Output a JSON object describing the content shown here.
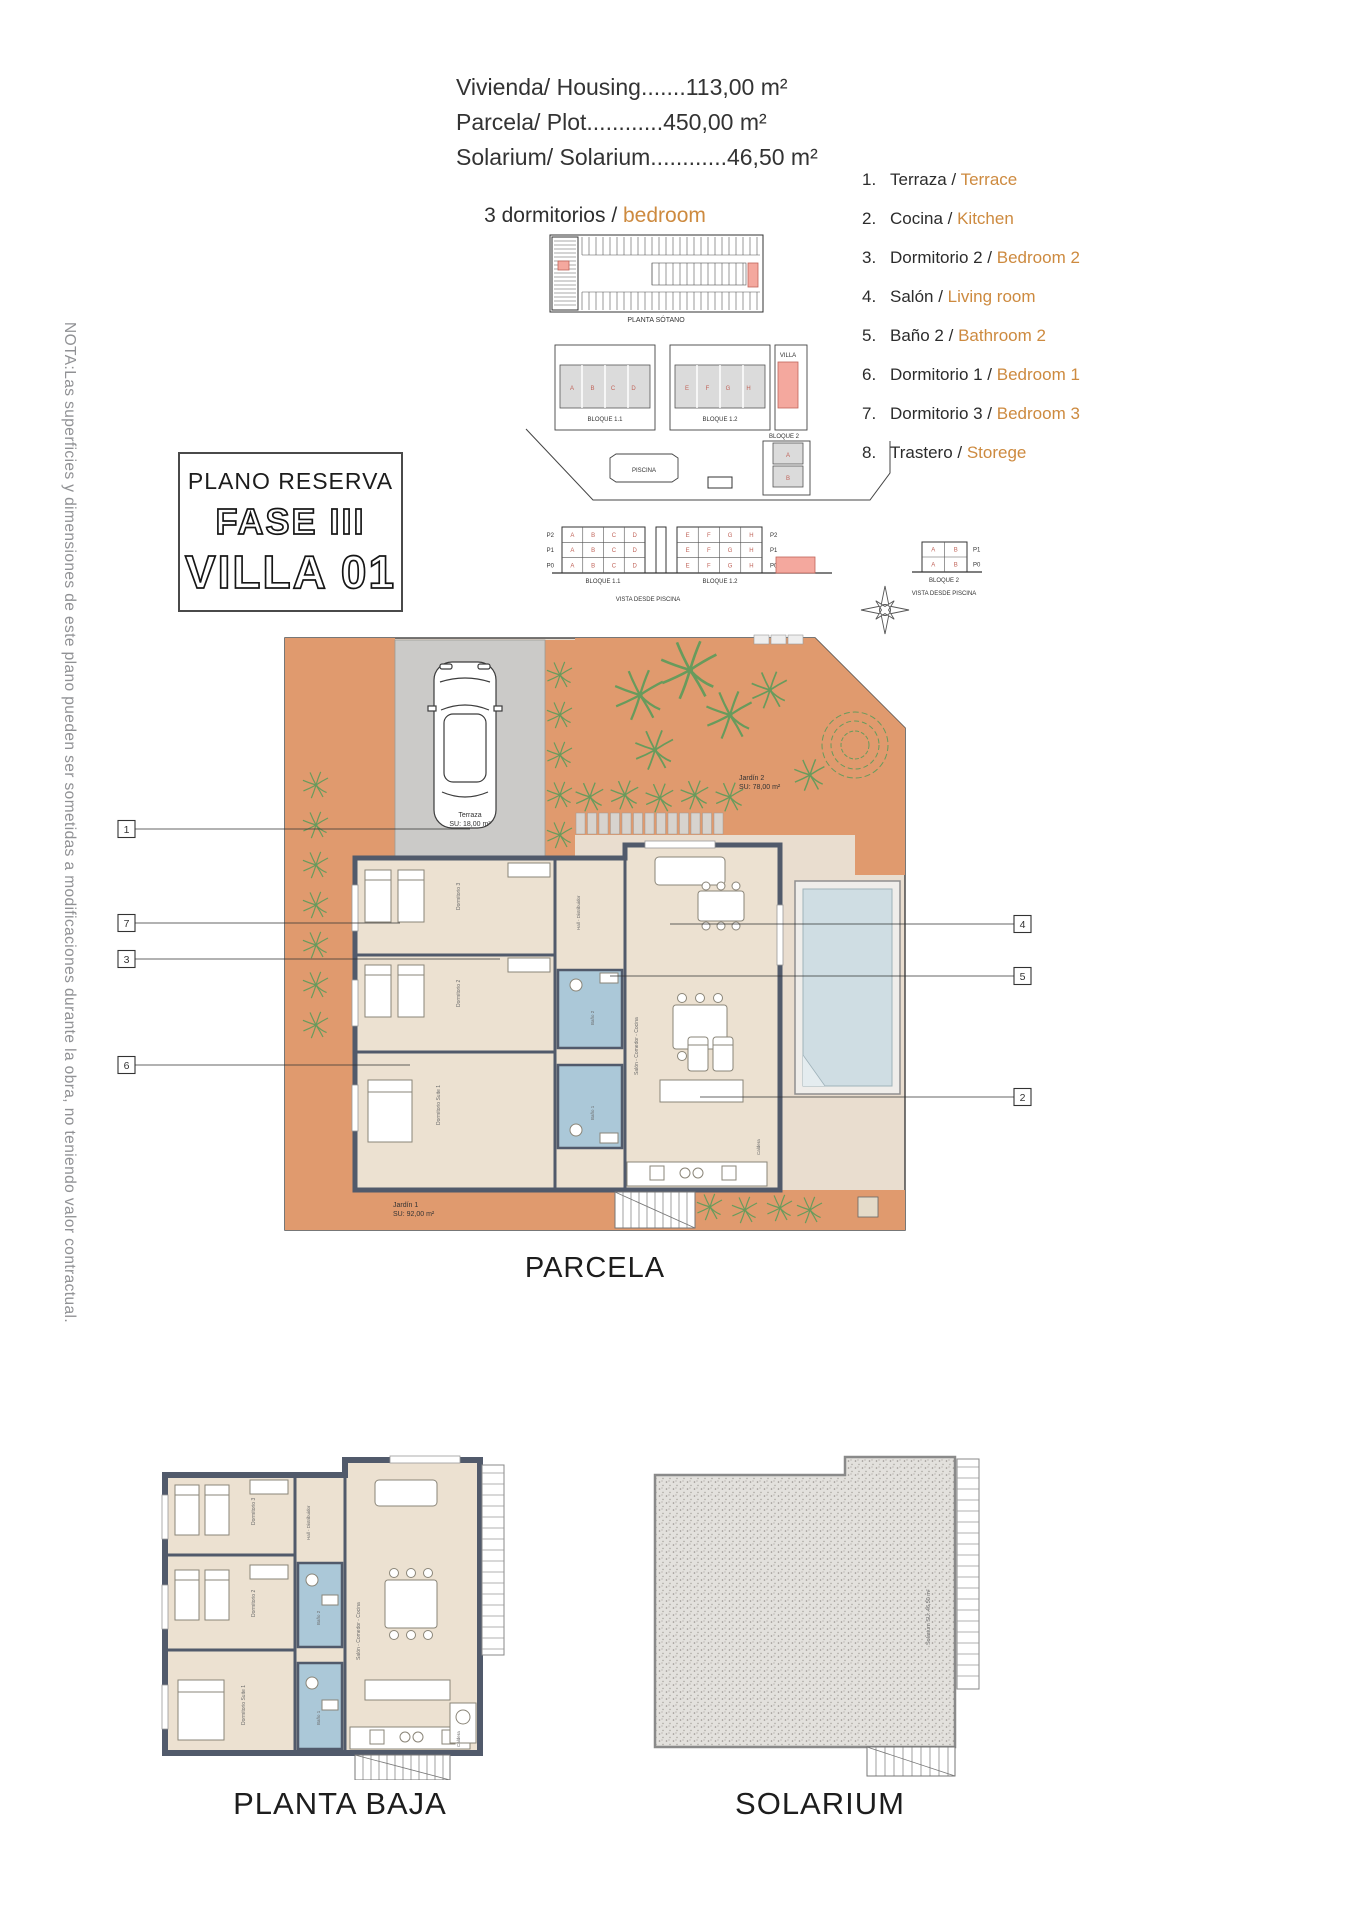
{
  "colors": {
    "accent_orange": "#cd8a3f",
    "terracotta": "#e09a6e",
    "pool_water": "#cfdde3",
    "bath_blue": "#abc8d8",
    "wall": "#515a6b",
    "highlight_pink": "#f4a89e",
    "palm_green": "#689b5c"
  },
  "header": {
    "measurements": [
      "Vivienda/ Housing.......113,00 m²",
      "Parcela/ Plot............450,00 m²",
      "Solarium/ Solarium............46,50 m²"
    ],
    "type_label_es": "3 dormitorios / ",
    "type_label_en": "bedroom"
  },
  "legend": {
    "items": [
      {
        "num": "1.",
        "es": "Terraza / ",
        "en": "Terrace"
      },
      {
        "num": "2.",
        "es": "Cocina / ",
        "en": "Kitchen"
      },
      {
        "num": "3.",
        "es": "Dormitorio 2 / ",
        "en": "Bedroom 2"
      },
      {
        "num": "4.",
        "es": "Salón / ",
        "en": "Living room"
      },
      {
        "num": "5.",
        "es": "Baño 2 / ",
        "en": "Bathroom 2"
      },
      {
        "num": "6.",
        "es": "Dormitorio 1 / ",
        "en": "Bedroom 1"
      },
      {
        "num": "7.",
        "es": "Dormitorio 3 / ",
        "en": "Bedroom 3"
      },
      {
        "num": "8.",
        "es": "Trastero / ",
        "en": "Storege"
      }
    ]
  },
  "title_box": {
    "line1": "PLANO RESERVA",
    "line2": "FASE III",
    "line3": "VILLA 01"
  },
  "note": "NOTA:Las superficies y dimensiones de este plano pueden ser sometidas a modificaciones durante la obra, no teniendo valor contractual.",
  "site": {
    "sotano_caption": "PLANTA SÓTANO",
    "bloque11": "BLOQUE 1.1",
    "bloque12": "BLOQUE 1.2",
    "bloque2": "BLOQUE 2",
    "piscina": "PISCINA",
    "villa": "VILLA",
    "vista_caption": "VISTA DESDE PISCINA",
    "units_left": [
      "A",
      "B",
      "C",
      "D"
    ],
    "units_right": [
      "E",
      "F",
      "G",
      "H"
    ],
    "units_b2": [
      "A",
      "B"
    ],
    "floors3": [
      "P2",
      "P1",
      "P0"
    ],
    "floors2": [
      "P1",
      "P0"
    ]
  },
  "parcela": {
    "caption": "PARCELA",
    "labels": {
      "terraza": [
        "Terraza",
        "SU: 18,00 m²"
      ],
      "jardin2": [
        "Jardín 2",
        "SU: 78,00 m²"
      ],
      "jardin1": [
        "Jardín 1",
        "SU: 92,00 m²"
      ]
    },
    "rooms": {
      "dorm3": "Dormitorio 3",
      "dorm2": "Dormitorio 2",
      "dorm1": "Dormitorio Suite 1",
      "bano2": "Baño 2",
      "bano1": "Baño 1",
      "salon": "Salón - Comedor - Cocina",
      "hall": "Hall - Distribuidor",
      "caldera": "Caldera"
    },
    "callouts_left": [
      "1",
      "7",
      "3",
      "6"
    ],
    "callouts_right": [
      "4",
      "5",
      "2"
    ]
  },
  "planta_baja": {
    "caption": "PLANTA BAJA"
  },
  "solarium": {
    "caption": "SOLARIUM",
    "label": "Solarium SU: 46,50 m²"
  }
}
